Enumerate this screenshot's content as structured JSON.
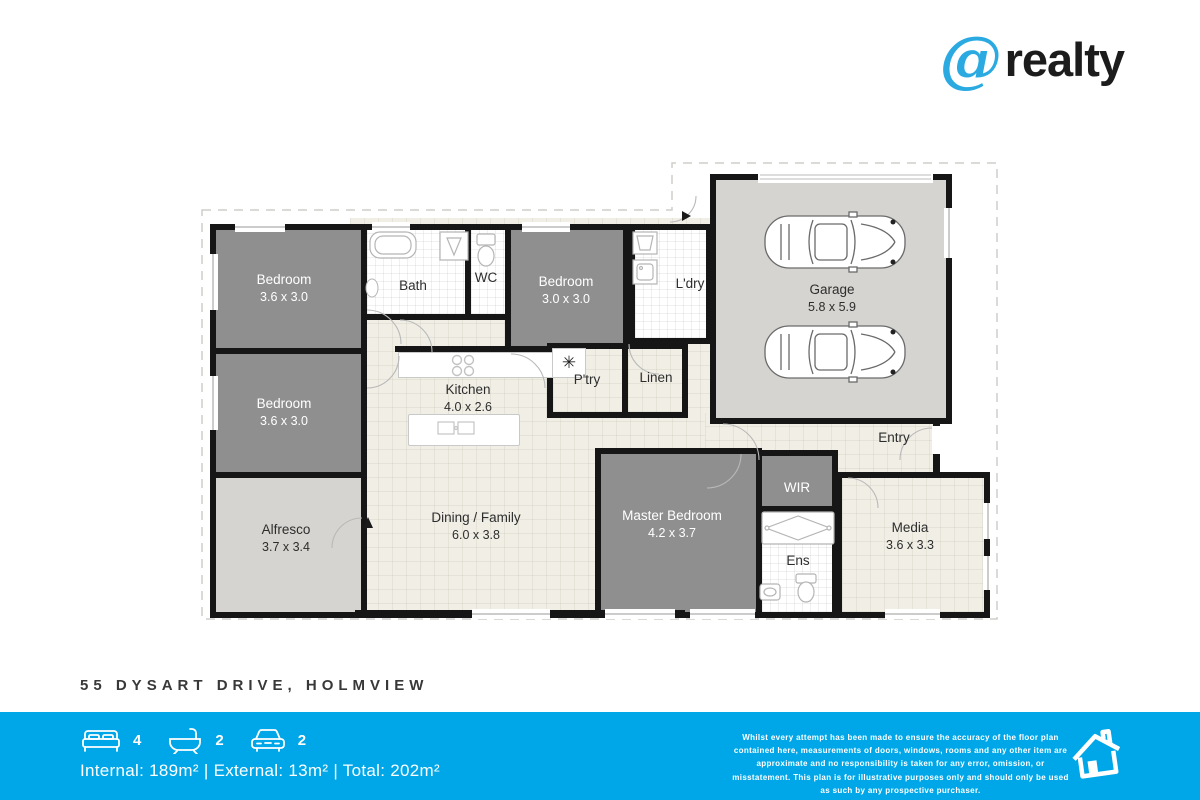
{
  "colors": {
    "bar_blue": "#00a7e8",
    "logo_blue": "#2baae2",
    "wall": "#161616"
  },
  "logo": {
    "at": "@",
    "name": "realty"
  },
  "plan": {
    "note": "✳",
    "rooms": {
      "bedroom1": {
        "label": "Bedroom",
        "dims": "3.6 x 3.0"
      },
      "bedroom2": {
        "label": "Bedroom",
        "dims": "3.0 x 3.0"
      },
      "bedroom3": {
        "label": "Bedroom",
        "dims": "3.6 x 3.0"
      },
      "bath": {
        "label": "Bath"
      },
      "wc": {
        "label": "WC"
      },
      "ldry": {
        "label": "L'dry"
      },
      "garage": {
        "label": "Garage",
        "dims": "5.8 x 5.9"
      },
      "kitchen": {
        "label": "Kitchen",
        "dims": "4.0 x 2.6"
      },
      "ptry": {
        "label": "P'try"
      },
      "linen": {
        "label": "Linen"
      },
      "entry": {
        "label": "Entry"
      },
      "alfresco": {
        "label": "Alfresco",
        "dims": "3.7 x 3.4"
      },
      "dining": {
        "label": "Dining / Family",
        "dims": "6.0 x 3.8"
      },
      "master": {
        "label": "Master Bedroom",
        "dims": "4.2 x 3.7"
      },
      "wir": {
        "label": "WIR"
      },
      "ens": {
        "label": "Ens"
      },
      "media": {
        "label": "Media",
        "dims": "3.6 x 3.3"
      }
    }
  },
  "address": "55 DYSART DRIVE, HOLMVIEW",
  "footer": {
    "beds": "4",
    "baths": "2",
    "cars": "2",
    "areas": "Internal: 189m² | External: 13m² | Total: 202m²",
    "disclaimer": "Whilst every attempt has been made to ensure the accuracy of the floor plan contained here, measurements of doors, windows, rooms and any other item are approximate and no responsibility is taken for any error, omission, or misstatement. This plan is for illustrative purposes only and should only be used as such by any prospective purchaser."
  }
}
